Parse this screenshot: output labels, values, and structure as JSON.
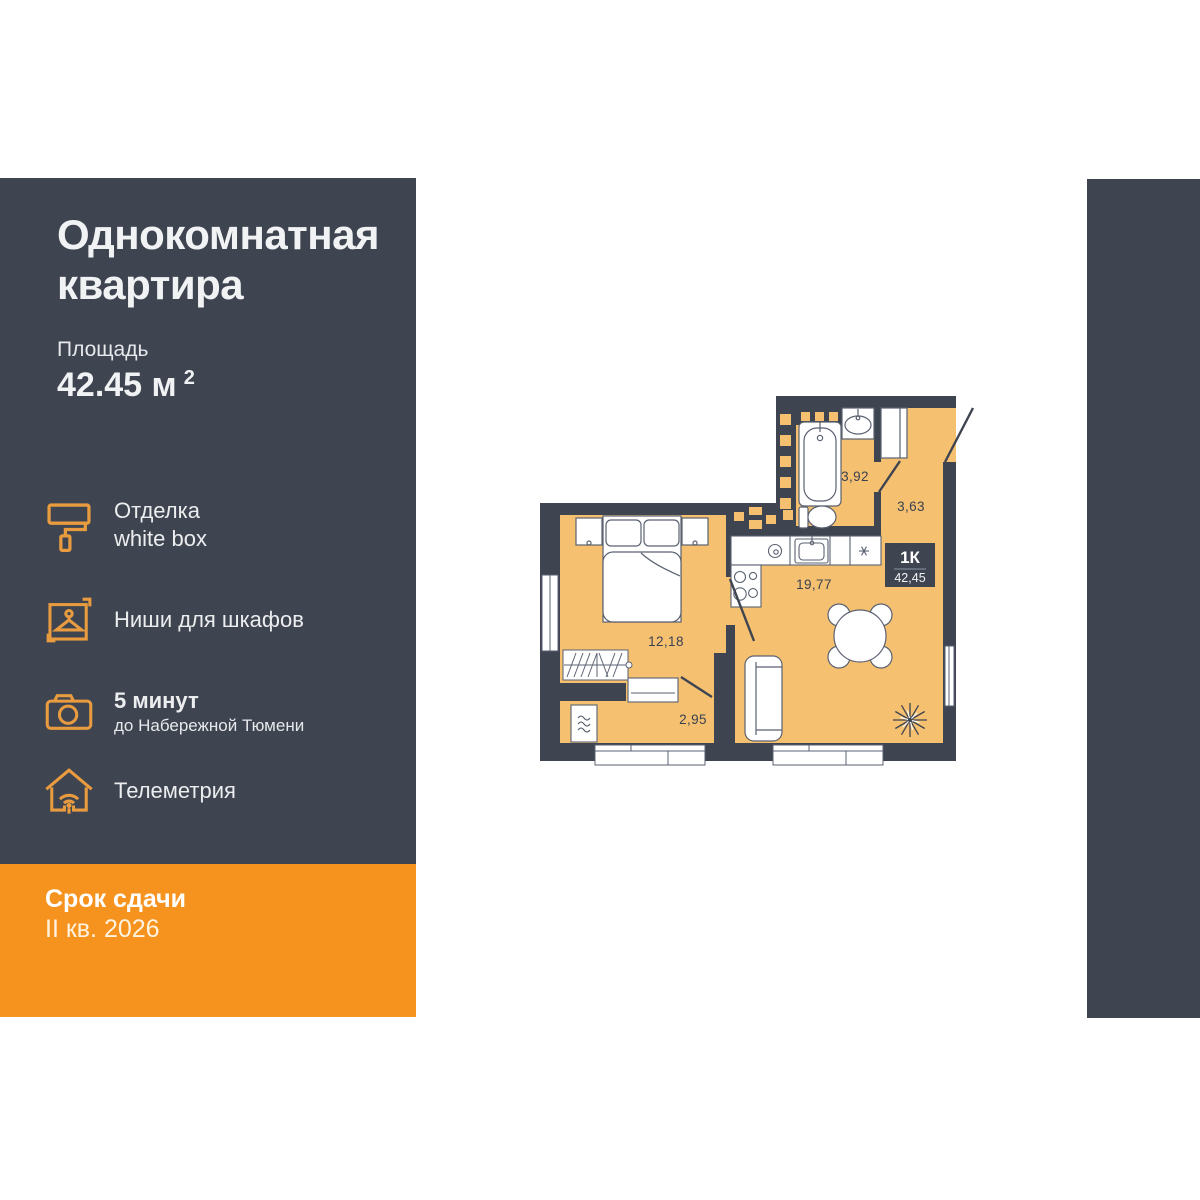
{
  "sidebar": {
    "title": "Однокомнатная квартира",
    "area_label": "Площадь",
    "area_value": "42.45 м",
    "area_sup": "2",
    "features": [
      {
        "icon": "paint-roller-icon",
        "line1": "Отделка",
        "line2": "white box"
      },
      {
        "icon": "hanger-icon",
        "line1": "Ниши для шкафов"
      },
      {
        "icon": "camera-icon",
        "line1": "5 минут",
        "line2": "до Набережной Тюмени"
      },
      {
        "icon": "house-wifi-icon",
        "line1": "Телеметрия"
      }
    ]
  },
  "deadline": {
    "label": "Срок сдачи",
    "value": "II кв. 2026"
  },
  "floor_plan": {
    "unit_label": "1К",
    "unit_area": "42,45",
    "rooms": [
      {
        "name": "bathroom",
        "area": "3,92"
      },
      {
        "name": "hallway",
        "area": "3,63"
      },
      {
        "name": "kitchen-living-room",
        "area": "19,77"
      },
      {
        "name": "bedroom",
        "area": "12,18"
      },
      {
        "name": "wardrobe-room",
        "area": "2,95"
      }
    ]
  },
  "colors": {
    "panel_dark": "#3E4450",
    "accent_orange": "#F6921E",
    "icon_orange": "#E99B3F",
    "floor_tan": "#F5C171",
    "furniture_white": "#FFFFFF"
  }
}
